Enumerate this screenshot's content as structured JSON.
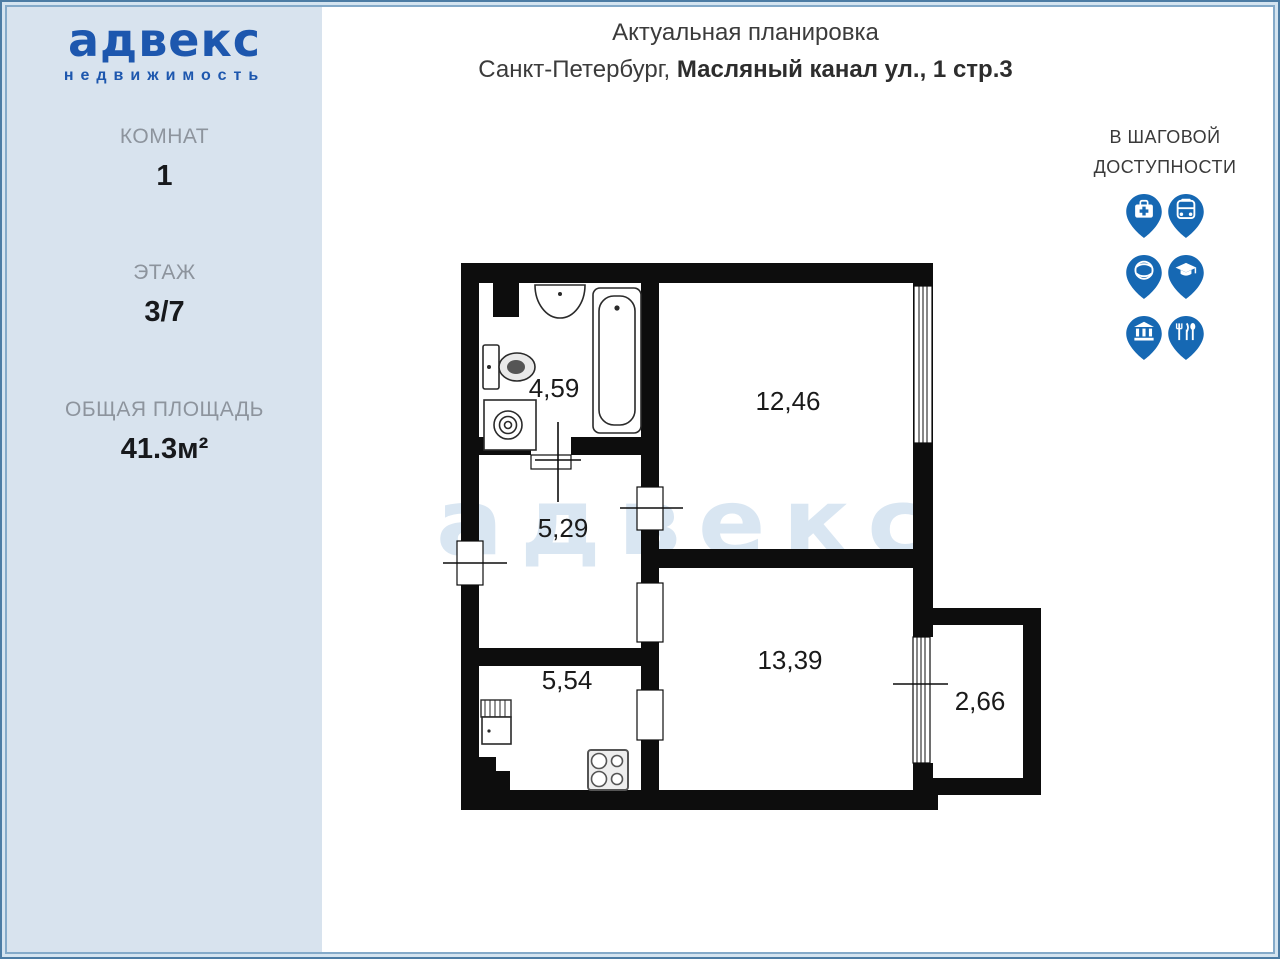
{
  "sidebar": {
    "logo": {
      "brand": "адвекс",
      "tagline": "недвижимость"
    },
    "stats": [
      {
        "label": "КОМНАТ",
        "value": "1"
      },
      {
        "label": "ЭТАЖ",
        "value": "3/7"
      },
      {
        "label": "ОБЩАЯ ПЛОЩАДЬ",
        "value": "41.3м²"
      }
    ]
  },
  "header": {
    "title": "Актуальная планировка",
    "address_prefix": "Санкт-Петербург, ",
    "address_bold": "Масляный канал ул., 1 стр.3"
  },
  "walkability": {
    "heading_line1": "В ШАГОВОЙ",
    "heading_line2": "ДОСТУПНОСТИ",
    "icons": [
      {
        "name": "medical-icon"
      },
      {
        "name": "bus-icon"
      },
      {
        "name": "sport-icon"
      },
      {
        "name": "education-icon"
      },
      {
        "name": "museum-icon"
      },
      {
        "name": "restaurant-icon"
      }
    ]
  },
  "floor_plan": {
    "watermark": "адвекс",
    "rooms": [
      {
        "name": "bathroom",
        "area": "4,59"
      },
      {
        "name": "bedroom",
        "area": "12,46"
      },
      {
        "name": "hallway",
        "area": "5,29"
      },
      {
        "name": "living-room",
        "area": "13,39"
      },
      {
        "name": "kitchen",
        "area": "5,54"
      },
      {
        "name": "balcony",
        "area": "2,66"
      }
    ]
  },
  "colors": {
    "brand_blue": "#1d57ae",
    "pin_blue": "#1668b3",
    "sidebar_bg": "#d8e3ee",
    "watermark": "#d9e6f2",
    "wall_black": "#0d0d0d"
  }
}
